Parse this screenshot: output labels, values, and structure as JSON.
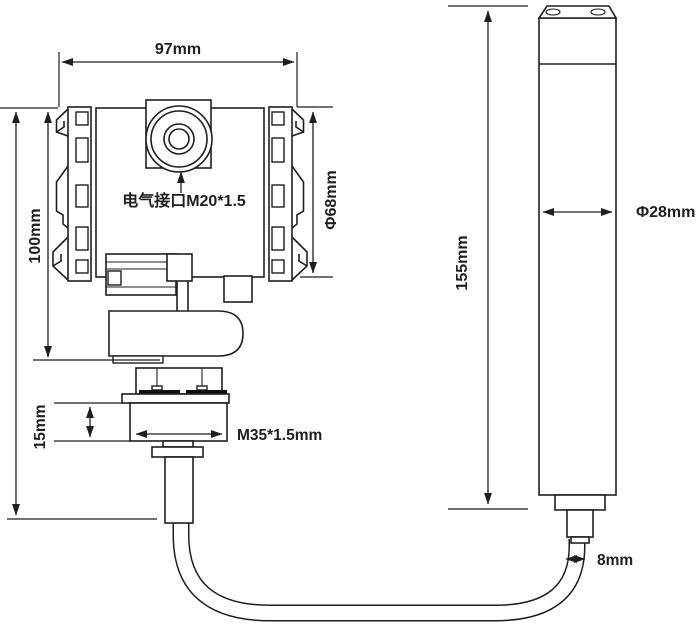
{
  "colors": {
    "line": "#1f1f1f",
    "text": "#1f1f1f",
    "background": "#ffffff",
    "bolt_fill": "#111111"
  },
  "drawing": {
    "transmitter": {
      "width_label": "97mm",
      "height_label": "100mm",
      "cap_diameter_label": "Φ68mm",
      "electrical_port_label": "电气接口M20*1.5",
      "thread_height_label": "15mm",
      "thread_spec_label": "M35*1.5mm"
    },
    "probe": {
      "length_label": "155mm",
      "diameter_label": "Φ28mm"
    },
    "cable": {
      "diameter_label": "8mm"
    }
  }
}
